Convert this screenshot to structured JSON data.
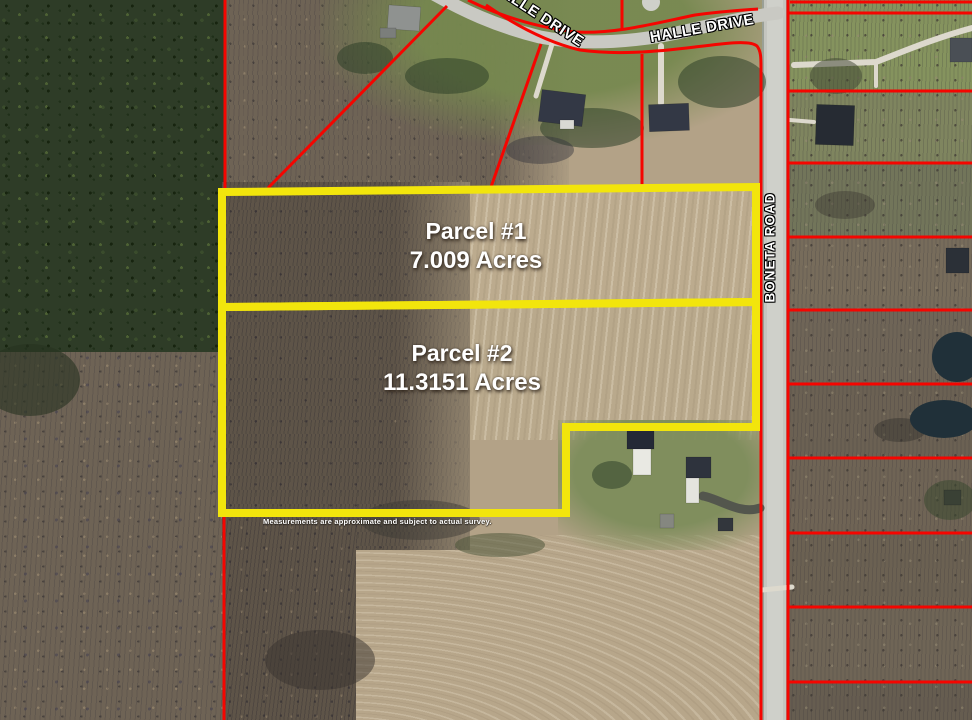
{
  "labels": {
    "halle_drive_west": "HALLE DRIVE",
    "halle_drive_east": "HALLE DRIVE",
    "boneta_road": "BONETA ROAD"
  },
  "parcels": [
    {
      "name": "Parcel #1",
      "acreage": "7.009 Acres"
    },
    {
      "name": "Parcel #2",
      "acreage": "11.3151 Acres"
    }
  ],
  "disclaimer": "Measurements are approximate and subject to actual survey.",
  "colors": {
    "parcel_boundary_red": "#f50500",
    "parcel_highlight_yellow": "#f2e50c",
    "road_pavement_gray": "#c9c9c3",
    "driveway_light": "#ddd9cd",
    "pond_dark": "#203039",
    "label_text_white": "#ffffff"
  }
}
